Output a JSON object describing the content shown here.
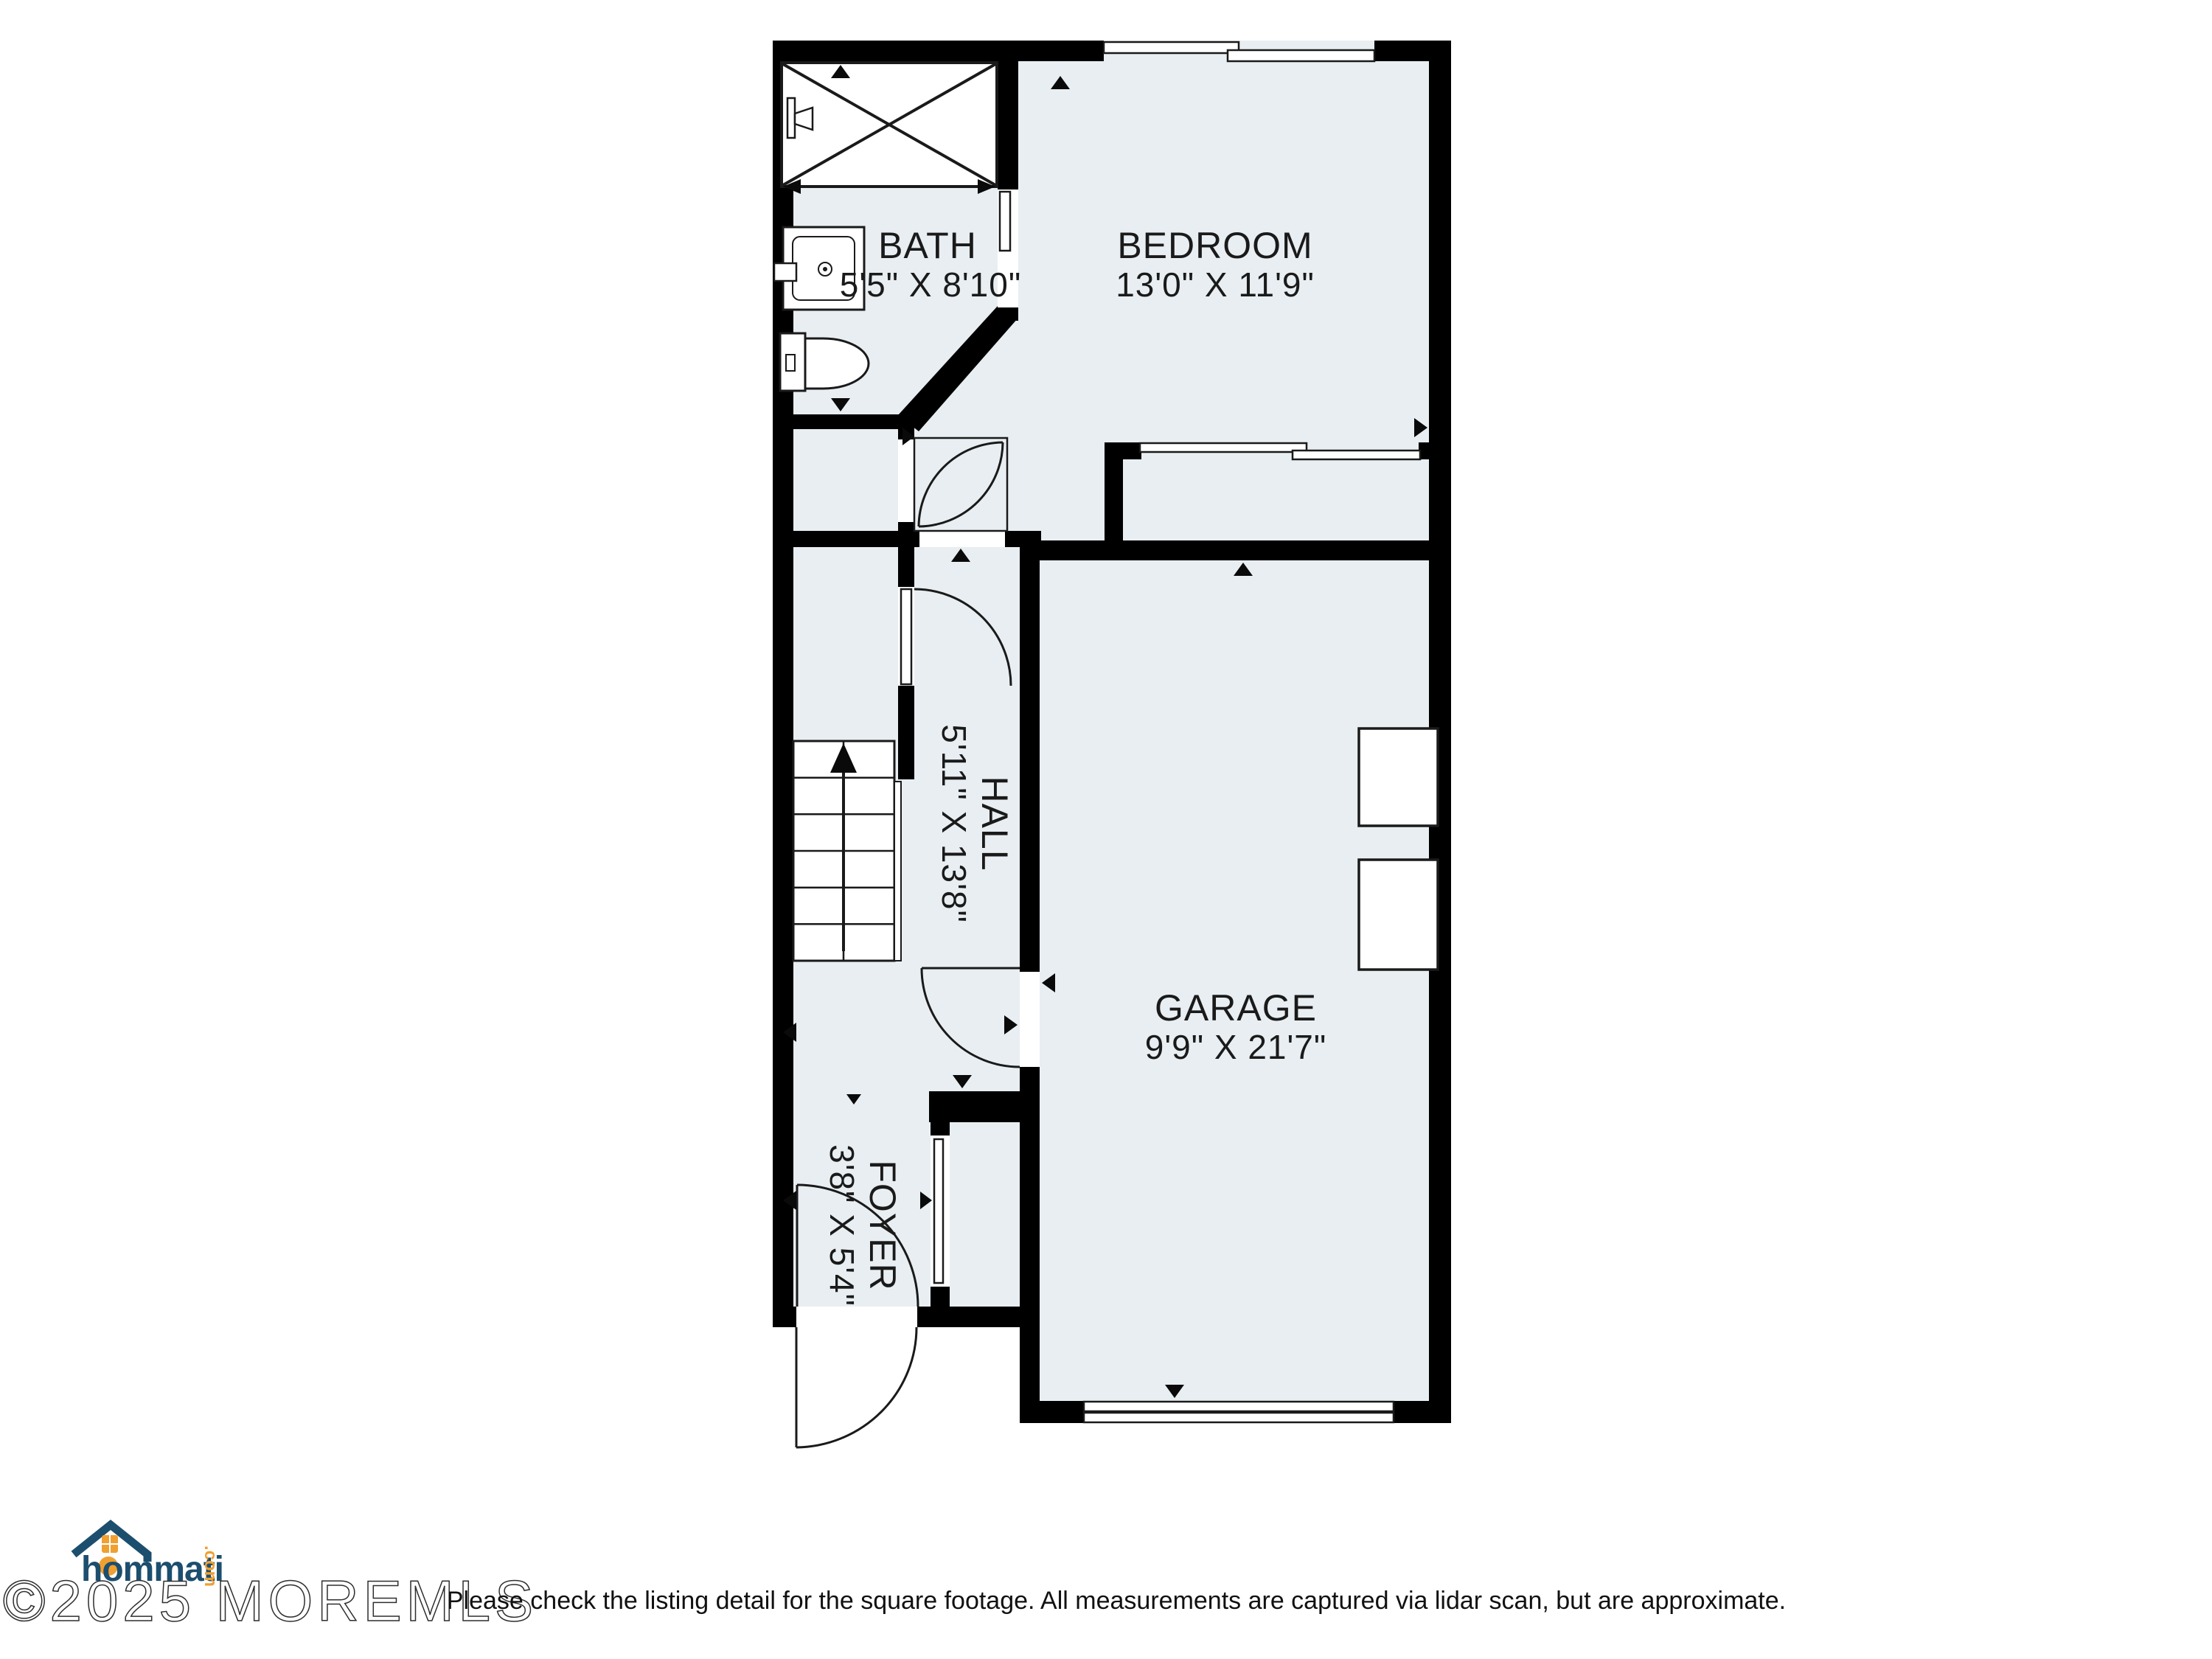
{
  "colors": {
    "floor": "#e8eef1",
    "wall": "#000000",
    "line": "#1a1a1a",
    "logo_navy": "#1c4e6e",
    "logo_orange": "#f0a030"
  },
  "rooms": {
    "bath": {
      "name": "BATH",
      "dims": "5'5\" X 8'10\""
    },
    "bedroom": {
      "name": "BEDROOM",
      "dims": "13'0\" X 11'9\""
    },
    "hall": {
      "name": "HALL",
      "dims": "5'11\" X 13'8\""
    },
    "garage": {
      "name": "GARAGE",
      "dims": "9'9\" X 21'7\""
    },
    "foyer": {
      "name": "FOYER",
      "dims": "3'8\" X 5'4\""
    }
  },
  "branding": {
    "logo_text": "hommati",
    "logo_tld": ".com",
    "watermark": "©2025 MOREMLS"
  },
  "footer": {
    "disclaimer": "Please check the listing detail for the square footage. All measurements are captured via lidar scan, but are approximate."
  }
}
